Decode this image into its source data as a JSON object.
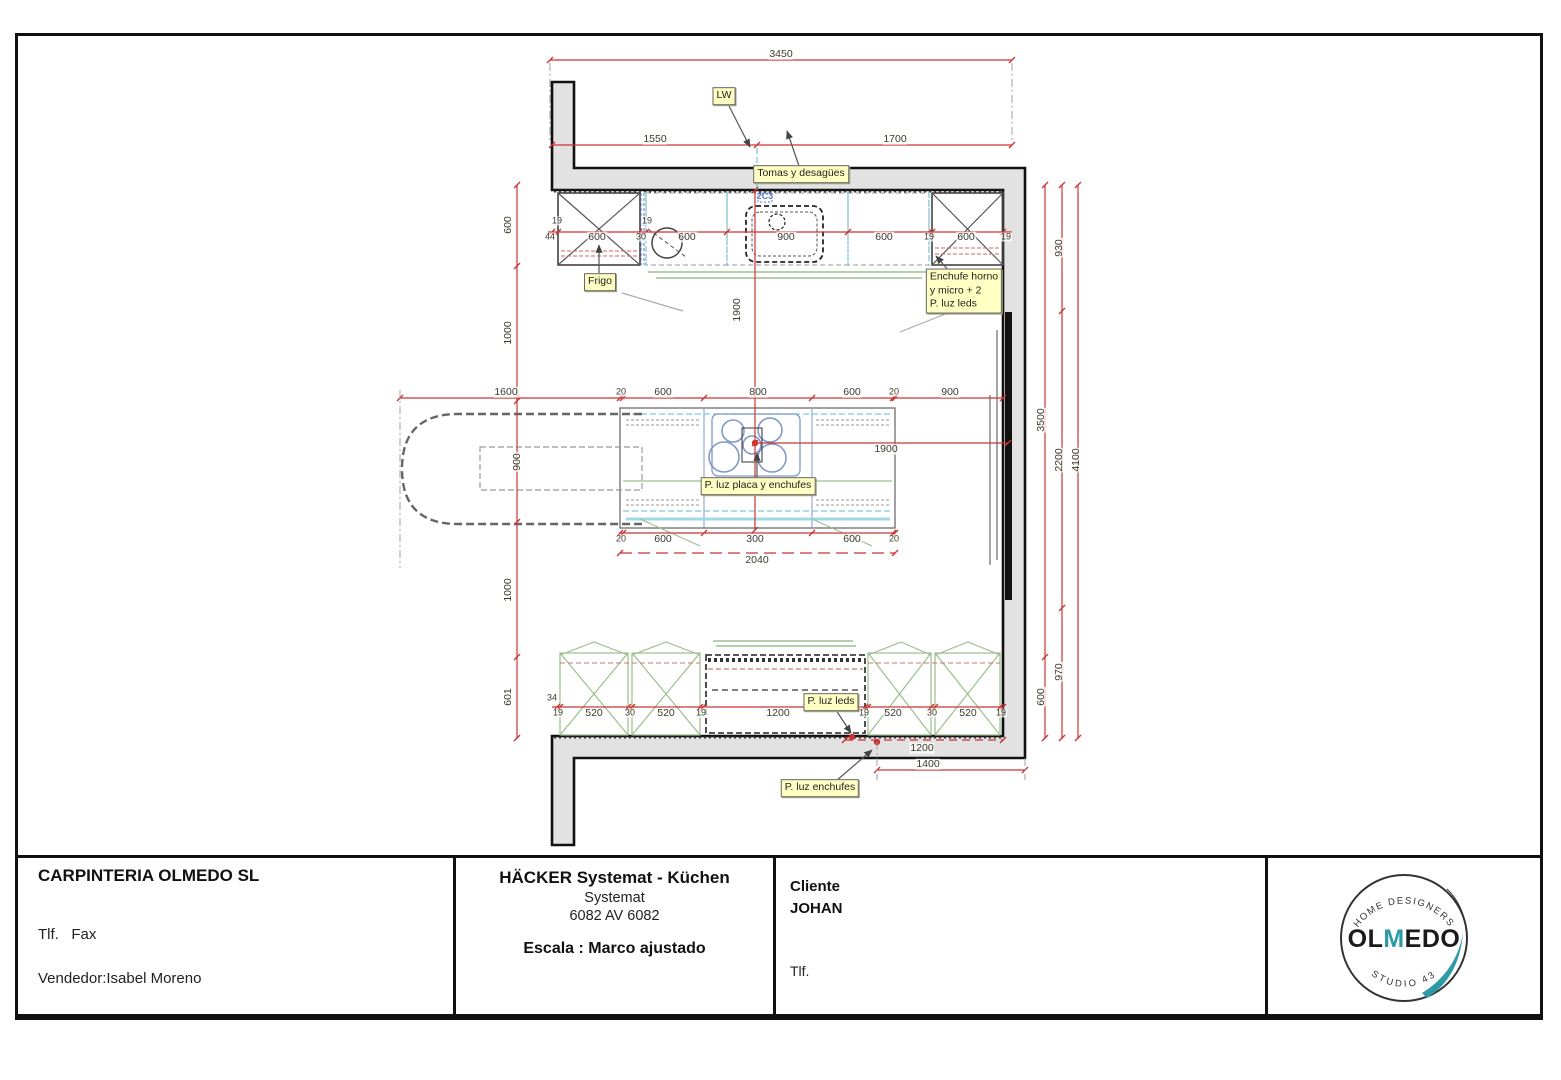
{
  "drawing": {
    "dim_labels": [
      {
        "t": "3450",
        "x": 781,
        "y": 54
      },
      {
        "t": "1550",
        "x": 655,
        "y": 139
      },
      {
        "t": "1700",
        "x": 895,
        "y": 139
      },
      {
        "t": "19",
        "x": 557,
        "y": 221,
        "cls": "sm"
      },
      {
        "t": "44",
        "x": 550,
        "y": 237,
        "cls": "sm"
      },
      {
        "t": "600",
        "x": 597,
        "y": 237
      },
      {
        "t": "30",
        "x": 641,
        "y": 237,
        "cls": "sm"
      },
      {
        "t": "19",
        "x": 647,
        "y": 221,
        "cls": "sm"
      },
      {
        "t": "600",
        "x": 687,
        "y": 237
      },
      {
        "t": "900",
        "x": 786,
        "y": 237
      },
      {
        "t": "600",
        "x": 884,
        "y": 237
      },
      {
        "t": "19",
        "x": 929,
        "y": 237,
        "cls": "sm"
      },
      {
        "t": "600",
        "x": 966,
        "y": 237
      },
      {
        "t": "19",
        "x": 1006,
        "y": 237,
        "cls": "sm"
      },
      {
        "t": "600",
        "x": 508,
        "y": 225,
        "r": true
      },
      {
        "t": "1000",
        "x": 508,
        "y": 333,
        "r": true
      },
      {
        "t": "900",
        "x": 517,
        "y": 462,
        "r": true
      },
      {
        "t": "1000",
        "x": 508,
        "y": 590,
        "r": true
      },
      {
        "t": "601",
        "x": 508,
        "y": 697,
        "r": true
      },
      {
        "t": "1600",
        "x": 506,
        "y": 392
      },
      {
        "t": "20",
        "x": 621,
        "y": 392,
        "cls": "sm"
      },
      {
        "t": "600",
        "x": 663,
        "y": 392
      },
      {
        "t": "800",
        "x": 758,
        "y": 392
      },
      {
        "t": "600",
        "x": 852,
        "y": 392
      },
      {
        "t": "20",
        "x": 894,
        "y": 392,
        "cls": "sm"
      },
      {
        "t": "900",
        "x": 950,
        "y": 392
      },
      {
        "t": "1900",
        "x": 737,
        "y": 310,
        "r": true
      },
      {
        "t": "1900",
        "x": 886,
        "y": 449
      },
      {
        "t": "20",
        "x": 621,
        "y": 539,
        "cls": "sm"
      },
      {
        "t": "600",
        "x": 663,
        "y": 539
      },
      {
        "t": "300",
        "x": 755,
        "y": 539
      },
      {
        "t": "600",
        "x": 852,
        "y": 539
      },
      {
        "t": "20",
        "x": 894,
        "y": 539,
        "cls": "sm"
      },
      {
        "t": "2040",
        "x": 757,
        "y": 560
      },
      {
        "t": "34",
        "x": 552,
        "y": 698,
        "cls": "sm"
      },
      {
        "t": "19",
        "x": 558,
        "y": 713,
        "cls": "sm"
      },
      {
        "t": "520",
        "x": 594,
        "y": 713
      },
      {
        "t": "30",
        "x": 630,
        "y": 713,
        "cls": "sm"
      },
      {
        "t": "520",
        "x": 666,
        "y": 713
      },
      {
        "t": "19",
        "x": 701,
        "y": 713,
        "cls": "sm"
      },
      {
        "t": "1200",
        "x": 778,
        "y": 713
      },
      {
        "t": "19",
        "x": 864,
        "y": 713,
        "cls": "sm"
      },
      {
        "t": "520",
        "x": 893,
        "y": 713
      },
      {
        "t": "30",
        "x": 932,
        "y": 713,
        "cls": "sm"
      },
      {
        "t": "520",
        "x": 968,
        "y": 713
      },
      {
        "t": "19",
        "x": 1001,
        "y": 713,
        "cls": "sm"
      },
      {
        "t": "1200",
        "x": 922,
        "y": 748
      },
      {
        "t": "1400",
        "x": 928,
        "y": 764
      },
      {
        "t": "3500",
        "x": 1041,
        "y": 420,
        "r": true
      },
      {
        "t": "600",
        "x": 1041,
        "y": 697,
        "r": true
      },
      {
        "t": "930",
        "x": 1059,
        "y": 248,
        "r": true
      },
      {
        "t": "2200",
        "x": 1059,
        "y": 460,
        "r": true
      },
      {
        "t": "970",
        "x": 1059,
        "y": 672,
        "r": true
      },
      {
        "t": "4100",
        "x": 1076,
        "y": 460,
        "r": true
      }
    ],
    "callouts": [
      {
        "t": "LW",
        "x": 724,
        "y": 96
      },
      {
        "t": "Tomas y desagües",
        "x": 801,
        "y": 174
      },
      {
        "t": "Frigo",
        "x": 600,
        "y": 282
      },
      {
        "t": "Enchufe horno\ny micro + 2\nP. luz leds",
        "x": 964,
        "y": 291,
        "cls": "left"
      },
      {
        "t": "P. luz placa y enchufes",
        "x": 758,
        "y": 486
      },
      {
        "t": "P. luz leds",
        "x": 831,
        "y": 702
      },
      {
        "t": "P. luz enchufes",
        "x": 820,
        "y": 788
      },
      {
        "t": "2C3",
        "x": 765,
        "y": 197,
        "cls": "blue"
      }
    ]
  },
  "titleblock": {
    "company": "CARPINTERIA OLMEDO SL",
    "phone_fax": "Tlf.   Fax",
    "vendor": "Vendedor:Isabel Moreno",
    "product_line1": "HÄCKER Systemat - Küchen",
    "product_line2": "Systemat",
    "product_line3": "6082 AV 6082",
    "scale_line": "Escala : Marco ajustado",
    "client_block": "Cliente\nJOHAN",
    "client_phone": "Tlf.",
    "logo": {
      "arc_top": "· HOME DESIGNERS ·",
      "name_part1": "OL",
      "name_part2": "M",
      "name_part3": "EDO",
      "arc_bottom": "STUDIO 43",
      "accent_color": "#2e9aa6"
    }
  },
  "colors": {
    "dimension_red": "#cc3333",
    "callout_yellow": "#ffffc4",
    "wall_gray": "#e2e2e2",
    "cabinet_green": "#9bbf8e",
    "utility_cyan": "#7cc8dd",
    "hob_blue": "#8098c8",
    "logo_teal": "#2e9aa6"
  }
}
